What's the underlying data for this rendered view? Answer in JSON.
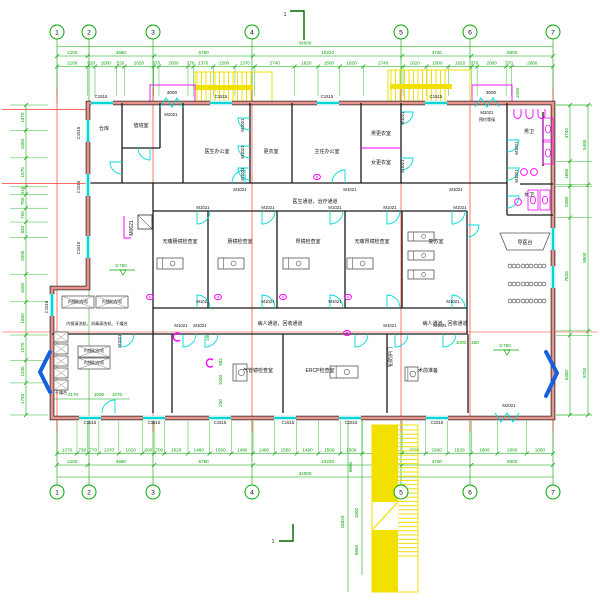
{
  "drawing": {
    "type": "architectural-floor-plan",
    "axis_bubbles": [
      "1",
      "2",
      "3",
      "4",
      "5",
      "6",
      "7"
    ],
    "dims": {
      "top_total": "34000",
      "top_spans": [
        "2100",
        "4560",
        "6780",
        "10220",
        "4740",
        "5600"
      ],
      "top_detail": [
        "2100",
        "520",
        "1500",
        "520",
        "2020",
        "370",
        "2000",
        "370",
        "1370",
        "1500",
        "1370",
        "2740",
        "1620",
        "1500",
        "1620",
        "2740",
        "1620",
        "1500",
        "1620",
        "370",
        "2000",
        "370",
        "2860"
      ],
      "bottom_detail": [
        "1370",
        "730",
        "770",
        "1370",
        "1620",
        "800",
        "700",
        "1620",
        "1480",
        "1500",
        "1480",
        "1490",
        "1500",
        "1490",
        "1500",
        "1500",
        "2740",
        "1620",
        "1500",
        "1620",
        "1800",
        "2000",
        "1800"
      ],
      "bottom_spans": [
        "2100",
        "4560",
        "6780",
        "10220",
        "4740",
        "5600"
      ],
      "bottom_total": "34000",
      "left_chain": [
        "1370",
        "1500",
        "1570",
        "410",
        "750",
        "750",
        "830",
        "2000",
        "1500",
        "1800",
        "1370",
        "1230",
        "1740"
      ],
      "right_inner": [
        "3740",
        "1660",
        "2080",
        "7820",
        "5300"
      ],
      "right_outer": [
        "5400",
        "9900",
        "5700"
      ],
      "stair_dims": [
        {
          "t": "8660",
          "x": 352,
          "y": 467,
          "r": 1
        },
        {
          "t": "18820",
          "x": 344,
          "y": 522,
          "r": 1
        },
        {
          "t": "1500",
          "x": 358,
          "y": 513,
          "r": 1
        },
        {
          "t": "8660",
          "x": 358,
          "y": 550,
          "r": 1
        }
      ],
      "misc": [
        {
          "t": "3000",
          "x": 172,
          "y": 94,
          "c": "k"
        },
        {
          "t": "3000",
          "x": 491,
          "y": 94,
          "c": "k"
        },
        {
          "t": "1500",
          "x": 519,
          "y": 93,
          "r": 1
        },
        {
          "t": "150",
          "x": 209,
          "y": 337,
          "r": 1
        },
        {
          "t": "462",
          "x": 222,
          "y": 362,
          "r": 1
        },
        {
          "t": "1000",
          "x": 222,
          "y": 380,
          "r": 1
        },
        {
          "t": "230",
          "x": 222,
          "y": 403,
          "r": 1
        },
        {
          "t": "2170",
          "x": 73,
          "y": 396
        },
        {
          "t": "1000",
          "x": 99,
          "y": 396
        },
        {
          "t": "1070",
          "x": 117,
          "y": 396
        },
        {
          "t": "1000",
          "x": 461,
          "y": 344
        },
        {
          "t": "150",
          "x": 475,
          "y": 344
        },
        {
          "t": "3.750",
          "x": 121,
          "y": 267
        },
        {
          "t": "3.750",
          "x": 505,
          "y": 347
        }
      ]
    },
    "rooms": [
      {
        "t": "仓库",
        "x": 104,
        "y": 130
      },
      {
        "t": "值班室",
        "x": 141,
        "y": 127
      },
      {
        "t": "医生办公室",
        "x": 217,
        "y": 153
      },
      {
        "t": "更衣室",
        "x": 271,
        "y": 153
      },
      {
        "t": "主任办公室",
        "x": 327,
        "y": 153
      },
      {
        "t": "男更衣室",
        "x": 381,
        "y": 135
      },
      {
        "t": "女更衣室",
        "x": 381,
        "y": 164
      },
      {
        "t": "男卫",
        "x": 529,
        "y": 133
      },
      {
        "t": "女卫",
        "x": 529,
        "y": 196
      },
      {
        "t": "无痛肠镜检查室",
        "x": 180,
        "y": 243
      },
      {
        "t": "肠镜检查室",
        "x": 240,
        "y": 243
      },
      {
        "t": "胃镜检查室",
        "x": 308,
        "y": 243
      },
      {
        "t": "无痛胃镜检查室",
        "x": 372,
        "y": 243
      },
      {
        "t": "复苏室",
        "x": 436,
        "y": 243
      },
      {
        "t": "气管镜检查室",
        "x": 258,
        "y": 372
      },
      {
        "t": "ERCP检查室",
        "x": 320,
        "y": 372
      },
      {
        "t": "术前准备",
        "x": 428,
        "y": 372
      },
      {
        "t": "导医台",
        "x": 525,
        "y": 244
      }
    ],
    "corridors": [
      {
        "t": "医生通道，治疗通道",
        "x": 315,
        "y": 203
      },
      {
        "t": "病人通道，回收通道",
        "x": 280,
        "y": 325
      },
      {
        "t": "病人通道，回收通道",
        "x": 445,
        "y": 325
      }
    ],
    "storage_labels": [
      {
        "t": "内镜贮存柜",
        "x": 78,
        "y": 303
      },
      {
        "t": "内镜贮存柜",
        "x": 112,
        "y": 303
      },
      {
        "t": "内镜贮存柜",
        "x": 94,
        "y": 352
      },
      {
        "t": "内镜贮存柜",
        "x": 94,
        "y": 364
      },
      {
        "t": "内镜清洗机、消毒清洗机、干燥台",
        "x": 97,
        "y": 325
      },
      {
        "t": "干燥台",
        "x": 61,
        "y": 394
      }
    ],
    "window_labels": [
      {
        "t": "C1515",
        "x": 101,
        "y": 98
      },
      {
        "t": "C1515",
        "x": 221,
        "y": 98
      },
      {
        "t": "C1515",
        "x": 327,
        "y": 98
      },
      {
        "t": "C1515",
        "x": 436,
        "y": 98
      },
      {
        "t": "C1515",
        "x": 90,
        "y": 424
      },
      {
        "t": "C1515",
        "x": 154,
        "y": 424
      },
      {
        "t": "C1515",
        "x": 220,
        "y": 424
      },
      {
        "t": "C1515",
        "x": 288,
        "y": 424
      },
      {
        "t": "C1515",
        "x": 351,
        "y": 424
      },
      {
        "t": "C1515",
        "x": 437,
        "y": 424
      },
      {
        "t": "C1515",
        "x": 80,
        "y": 133,
        "r": 1
      },
      {
        "t": "C1515",
        "x": 80,
        "y": 187,
        "r": 1
      },
      {
        "t": "C1515",
        "x": 80,
        "y": 248,
        "r": 1
      },
      {
        "t": "C1515",
        "x": 48,
        "y": 307,
        "r": 1
      }
    ],
    "door_labels": [
      {
        "t": "M2021",
        "x": 171,
        "y": 116
      },
      {
        "t": "M2021",
        "x": 487,
        "y": 114
      },
      {
        "t": "M2021",
        "x": 509,
        "y": 407
      },
      {
        "t": "预约等候",
        "x": 487,
        "y": 121,
        "cls": "tiny"
      },
      {
        "t": "M1021",
        "x": 240,
        "y": 191
      },
      {
        "t": "M1021",
        "x": 350,
        "y": 191
      },
      {
        "t": "M1021",
        "x": 456,
        "y": 191
      },
      {
        "t": "M1021",
        "x": 203,
        "y": 209
      },
      {
        "t": "M1021",
        "x": 268,
        "y": 209
      },
      {
        "t": "M1021",
        "x": 335,
        "y": 209
      },
      {
        "t": "M1021",
        "x": 390,
        "y": 209
      },
      {
        "t": "M1021",
        "x": 460,
        "y": 209
      },
      {
        "t": "M1021",
        "x": 203,
        "y": 303
      },
      {
        "t": "M1021",
        "x": 268,
        "y": 303
      },
      {
        "t": "M1021",
        "x": 335,
        "y": 303
      },
      {
        "t": "M1021",
        "x": 453,
        "y": 303
      },
      {
        "t": "M1021",
        "x": 181,
        "y": 327
      },
      {
        "t": "M1021",
        "x": 200,
        "y": 327
      },
      {
        "t": "M1021",
        "x": 390,
        "y": 327
      },
      {
        "t": "M1021",
        "x": 440,
        "y": 327
      },
      {
        "t": "M1021",
        "x": 244,
        "y": 125,
        "r": 1
      },
      {
        "t": "M1021",
        "x": 244,
        "y": 152,
        "r": 1
      },
      {
        "t": "M1021",
        "x": 244,
        "y": 174,
        "r": 1
      },
      {
        "t": "M1021",
        "x": 404,
        "y": 118,
        "r": 1
      },
      {
        "t": "M1021",
        "x": 404,
        "y": 166,
        "r": 1
      },
      {
        "t": "M1021",
        "x": 518,
        "y": 148,
        "r": 1
      },
      {
        "t": "M1021",
        "x": 518,
        "y": 176,
        "r": 1
      },
      {
        "t": "M1021",
        "x": 121,
        "y": 341,
        "r": 1
      }
    ],
    "annotations": [
      {
        "t": "1",
        "x": 285,
        "y": 16
      },
      {
        "t": "1",
        "x": 273,
        "y": 543
      },
      {
        "t": "M0621",
        "x": 133,
        "y": 228,
        "r": 1
      },
      {
        "t": "铅防护门",
        "x": 392,
        "y": 357,
        "r": 1
      }
    ],
    "colors": {
      "grid_green": "#00a500",
      "axis_red": "#ff3b30",
      "window_cyan": "#00d8d8",
      "fixture_magenta": "#ff00ff",
      "stair_yellow": "#f2e000",
      "wall_fill": "#e8938c",
      "entry_arrow_blue": "#1560dd"
    }
  }
}
